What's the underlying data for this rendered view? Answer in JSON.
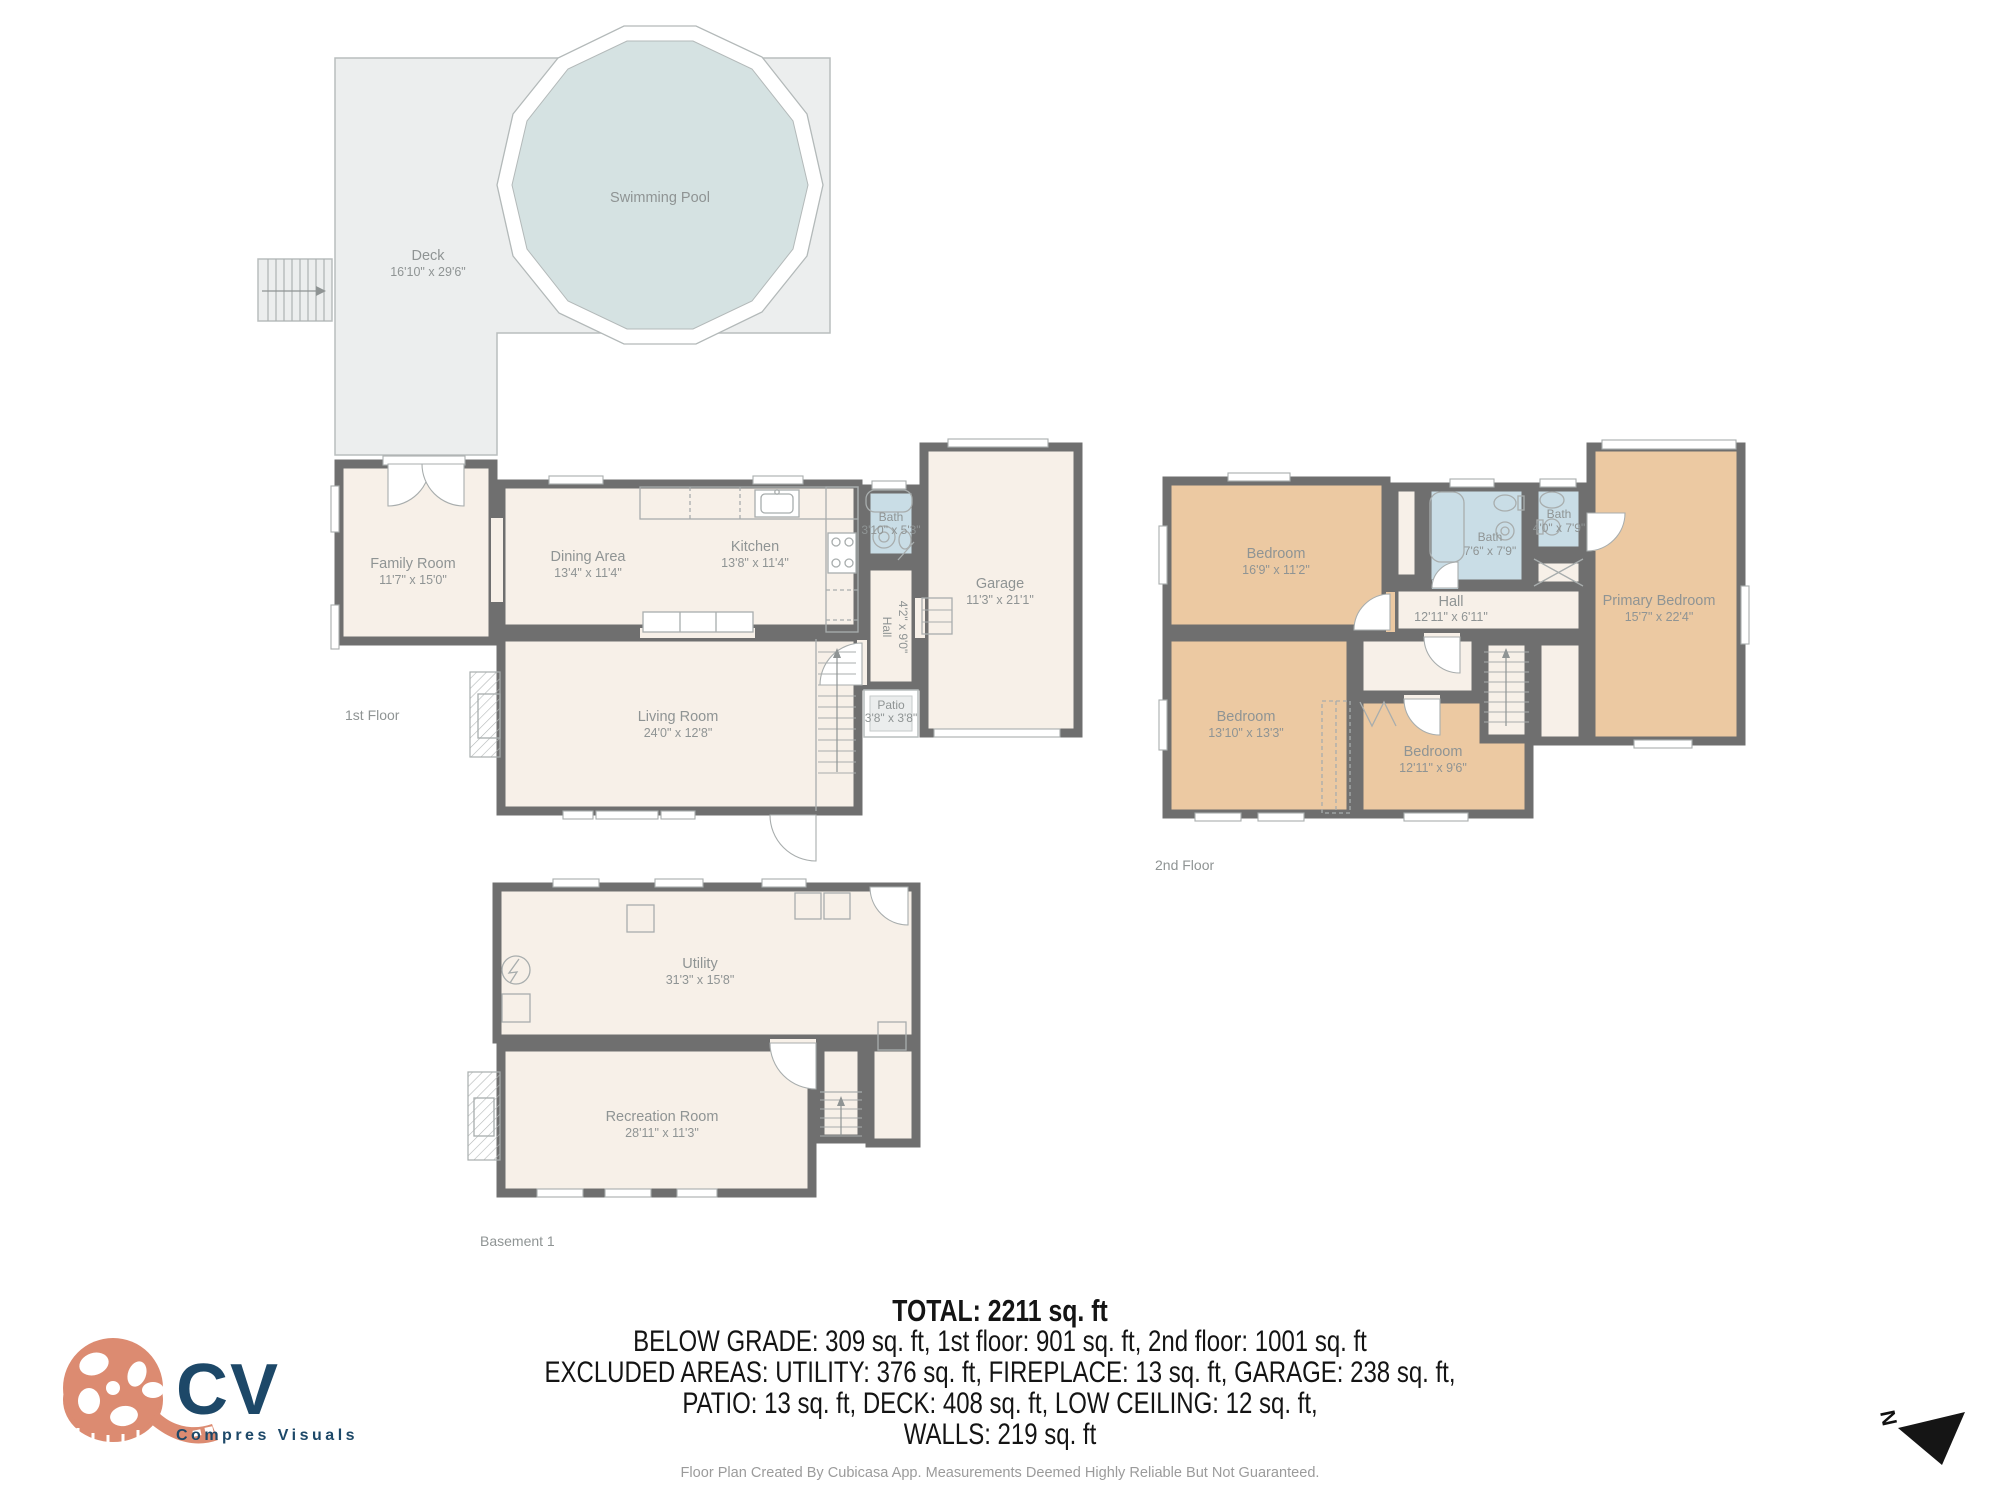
{
  "colors": {
    "wall": "#6f6f6f",
    "cream": "#f7f0e8",
    "tan": "#ecc9a2",
    "bath": "#c9dde6",
    "pool": "#d5e2e2",
    "deck": "#eceeee",
    "label": "#8f9494",
    "salmon": "#dc8b71",
    "navy": "#1d4868"
  },
  "first_floor": {
    "label": "1st Floor",
    "outdoor": {
      "deck": {
        "name": "Deck",
        "dims": "16'10\" x 29'6\""
      },
      "swimming_pool": {
        "name": "Swimming Pool"
      }
    },
    "rooms": {
      "family_room": {
        "name": "Family Room",
        "dims": "11'7\" x 15'0\""
      },
      "dining_area": {
        "name": "Dining Area",
        "dims": "13'4\" x 11'4\""
      },
      "kitchen": {
        "name": "Kitchen",
        "dims": "13'8\" x 11'4\""
      },
      "bath": {
        "name": "Bath",
        "dims": "3'10\" x 5'3\""
      },
      "hall": {
        "name": "Hall",
        "dims": "4'2\" x 9'0\""
      },
      "garage": {
        "name": "Garage",
        "dims": "11'3\" x 21'1\""
      },
      "living_room": {
        "name": "Living Room",
        "dims": "24'0\" x 12'8\""
      },
      "patio": {
        "name": "Patio",
        "dims": "3'8\" x 3'8\""
      }
    }
  },
  "second_floor": {
    "label": "2nd Floor",
    "rooms": {
      "bedroom_1": {
        "name": "Bedroom",
        "dims": "16'9\" x 11'2\""
      },
      "bath_1": {
        "name": "Bath",
        "dims": "7'6\" x 7'9\""
      },
      "bath_2": {
        "name": "Bath",
        "dims": "4'0\" x 7'9\""
      },
      "hall": {
        "name": "Hall",
        "dims": "12'11\" x 6'11\""
      },
      "primary_bedroom": {
        "name": "Primary Bedroom",
        "dims": "15'7\" x 22'4\""
      },
      "bedroom_2": {
        "name": "Bedroom",
        "dims": "13'10\" x 13'3\""
      },
      "bedroom_3": {
        "name": "Bedroom",
        "dims": "12'11\" x 9'6\""
      }
    }
  },
  "basement": {
    "label": "Basement 1",
    "rooms": {
      "utility": {
        "name": "Utility",
        "dims": "31'3\" x 15'8\""
      },
      "recreation_room": {
        "name": "Recreation Room",
        "dims": "28'11\" x 11'3\""
      }
    }
  },
  "summary": {
    "total": "TOTAL: 2211 sq. ft",
    "grade_line": "BELOW GRADE: 309 sq. ft, 1st floor: 901 sq. ft, 2nd floor: 1001 sq. ft",
    "excluded_line_1": "EXCLUDED AREAS: UTILITY: 376 sq. ft, FIREPLACE: 13 sq. ft, GARAGE: 238 sq. ft,",
    "excluded_line_2": "PATIO: 13 sq. ft, DECK: 408 sq. ft, LOW CEILING: 12 sq. ft,",
    "walls_line": "WALLS: 219 sq. ft"
  },
  "footer": {
    "disclaimer": "Floor Plan Created By Cubicasa App. Measurements Deemed Highly Reliable But Not Guaranteed."
  },
  "logo": {
    "initials": "CV",
    "company": "Compres Visuals"
  },
  "compass": {
    "north_label": "N"
  }
}
